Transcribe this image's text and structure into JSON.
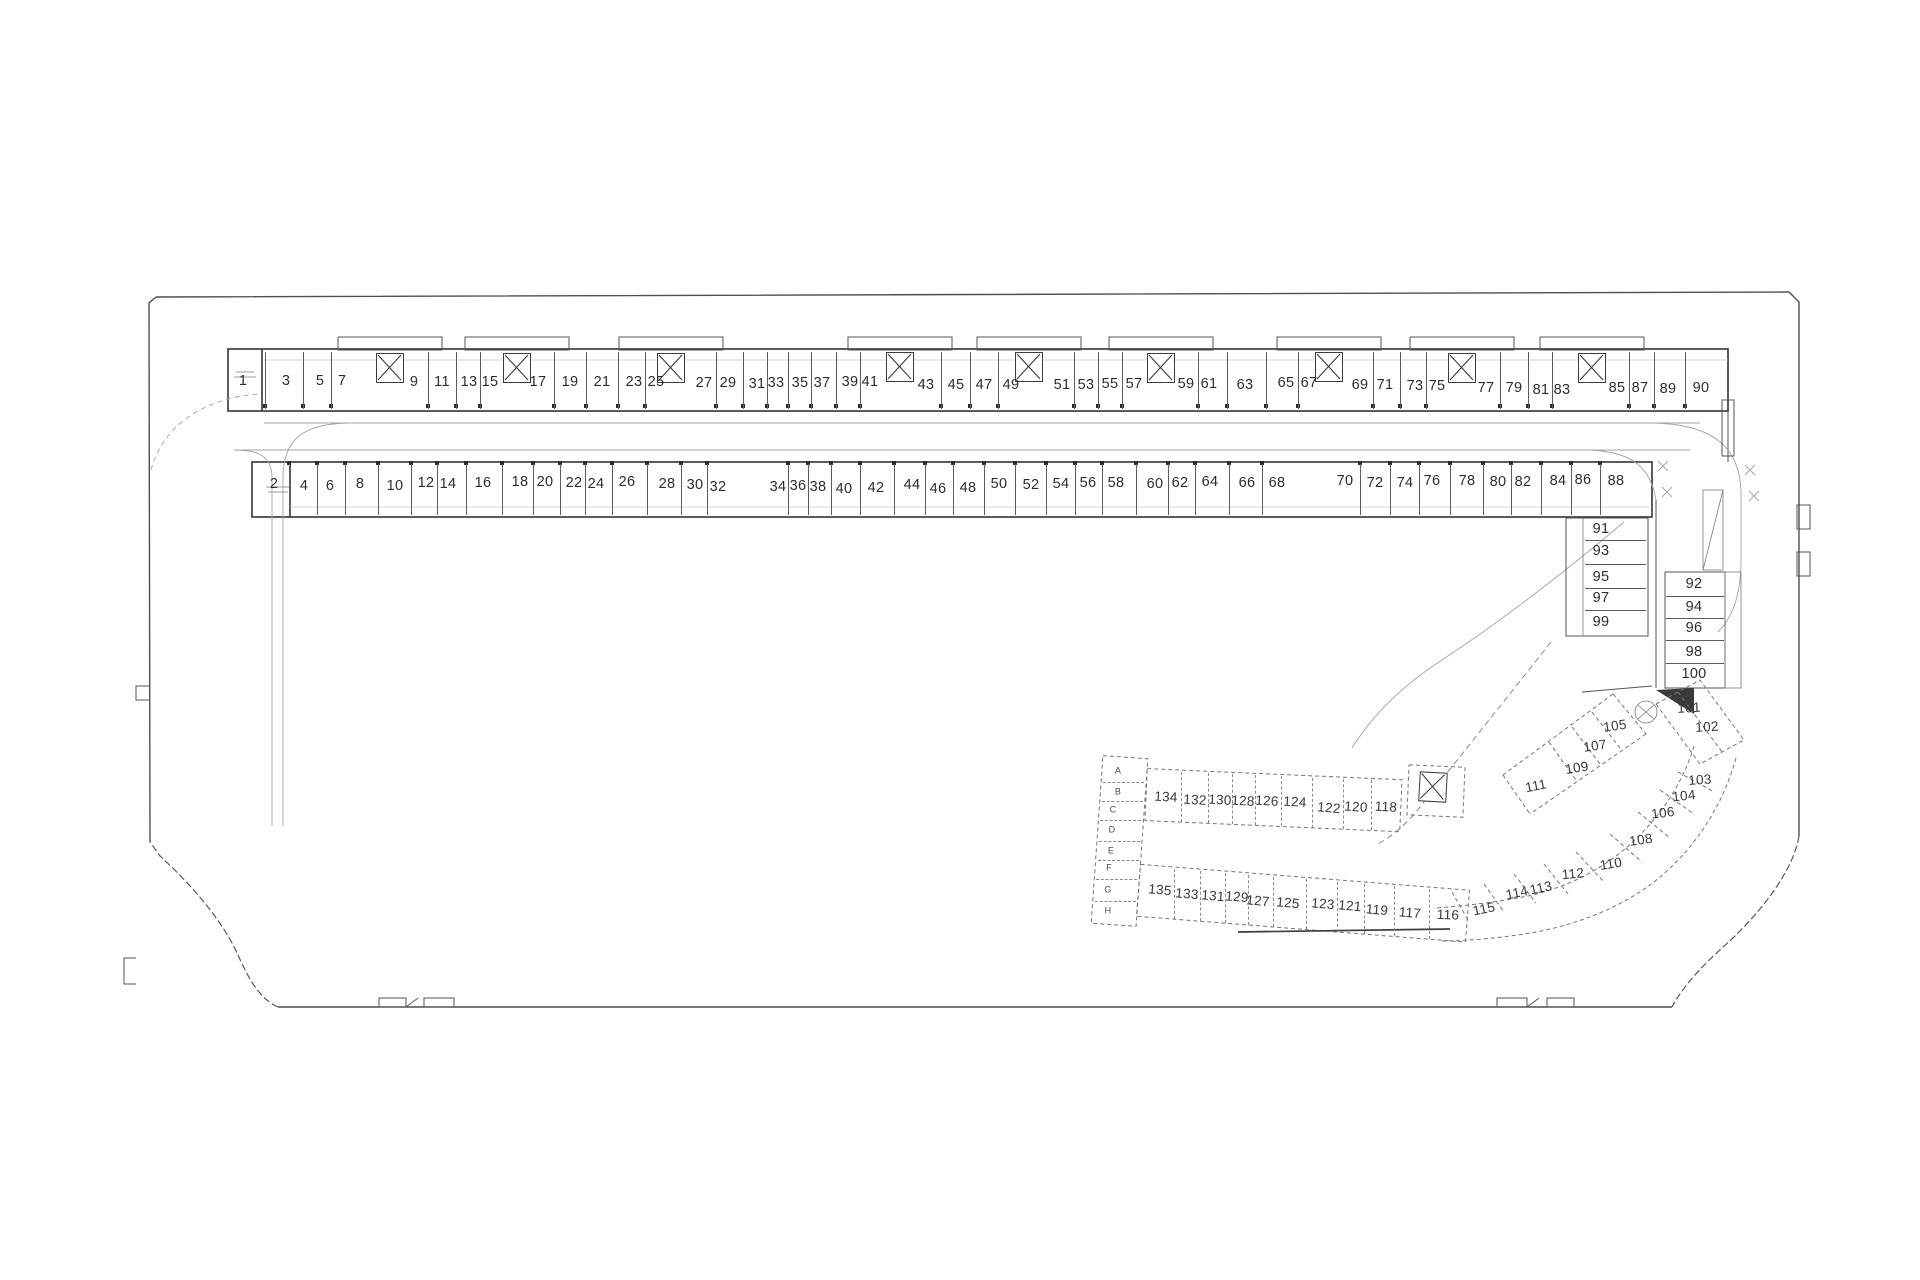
{
  "plan": {
    "colors": {
      "background": "#ffffff",
      "boundary_line": "#4f4f4f",
      "wall_line": "#3f3f3f",
      "dashed_section_line": "#767676",
      "label_text": "#2d2d2d"
    },
    "labels": [
      {
        "t": "1",
        "x": 243,
        "y": 381,
        "g": "r1"
      },
      {
        "t": "3",
        "x": 286,
        "y": 381,
        "g": "r1"
      },
      {
        "t": "5",
        "x": 320,
        "y": 381,
        "g": "r1"
      },
      {
        "t": "7",
        "x": 342,
        "y": 381,
        "g": "r1"
      },
      {
        "t": "9",
        "x": 414,
        "y": 382,
        "g": "r1"
      },
      {
        "t": "11",
        "x": 442,
        "y": 382,
        "g": "r1"
      },
      {
        "t": "13",
        "x": 469,
        "y": 382,
        "g": "r1"
      },
      {
        "t": "15",
        "x": 490,
        "y": 382,
        "g": "r1"
      },
      {
        "t": "17",
        "x": 538,
        "y": 382,
        "g": "r1"
      },
      {
        "t": "19",
        "x": 570,
        "y": 382,
        "g": "r1"
      },
      {
        "t": "21",
        "x": 602,
        "y": 382,
        "g": "r1"
      },
      {
        "t": "23",
        "x": 634,
        "y": 382,
        "g": "r1"
      },
      {
        "t": "25",
        "x": 656,
        "y": 382,
        "g": "r1"
      },
      {
        "t": "27",
        "x": 704,
        "y": 383,
        "g": "r1"
      },
      {
        "t": "29",
        "x": 728,
        "y": 383,
        "g": "r1"
      },
      {
        "t": "31",
        "x": 757,
        "y": 384,
        "g": "r1"
      },
      {
        "t": "33",
        "x": 776,
        "y": 383,
        "g": "r1"
      },
      {
        "t": "35",
        "x": 800,
        "y": 383,
        "g": "r1"
      },
      {
        "t": "37",
        "x": 822,
        "y": 383,
        "g": "r1"
      },
      {
        "t": "39",
        "x": 850,
        "y": 382,
        "g": "r1"
      },
      {
        "t": "41",
        "x": 870,
        "y": 382,
        "g": "r1"
      },
      {
        "t": "43",
        "x": 926,
        "y": 385,
        "g": "r1"
      },
      {
        "t": "45",
        "x": 956,
        "y": 385,
        "g": "r1"
      },
      {
        "t": "47",
        "x": 984,
        "y": 385,
        "g": "r1"
      },
      {
        "t": "49",
        "x": 1011,
        "y": 385,
        "g": "r1"
      },
      {
        "t": "51",
        "x": 1062,
        "y": 385,
        "g": "r1"
      },
      {
        "t": "53",
        "x": 1086,
        "y": 385,
        "g": "r1"
      },
      {
        "t": "55",
        "x": 1110,
        "y": 384,
        "g": "r1"
      },
      {
        "t": "57",
        "x": 1134,
        "y": 384,
        "g": "r1"
      },
      {
        "t": "59",
        "x": 1186,
        "y": 384,
        "g": "r1"
      },
      {
        "t": "61",
        "x": 1209,
        "y": 384,
        "g": "r1"
      },
      {
        "t": "63",
        "x": 1245,
        "y": 385,
        "g": "r1"
      },
      {
        "t": "65",
        "x": 1286,
        "y": 383,
        "g": "r1"
      },
      {
        "t": "67",
        "x": 1309,
        "y": 383,
        "g": "r1"
      },
      {
        "t": "69",
        "x": 1360,
        "y": 385,
        "g": "r1"
      },
      {
        "t": "71",
        "x": 1385,
        "y": 385,
        "g": "r1"
      },
      {
        "t": "73",
        "x": 1415,
        "y": 386,
        "g": "r1"
      },
      {
        "t": "75",
        "x": 1437,
        "y": 386,
        "g": "r1"
      },
      {
        "t": "77",
        "x": 1486,
        "y": 388,
        "g": "r1"
      },
      {
        "t": "79",
        "x": 1514,
        "y": 388,
        "g": "r1"
      },
      {
        "t": "81",
        "x": 1541,
        "y": 390,
        "g": "r1"
      },
      {
        "t": "83",
        "x": 1562,
        "y": 390,
        "g": "r1"
      },
      {
        "t": "85",
        "x": 1617,
        "y": 388,
        "g": "r1"
      },
      {
        "t": "87",
        "x": 1640,
        "y": 388,
        "g": "r1"
      },
      {
        "t": "89",
        "x": 1668,
        "y": 389,
        "g": "r1"
      },
      {
        "t": "90",
        "x": 1701,
        "y": 388,
        "g": "r1"
      },
      {
        "t": "2",
        "x": 274,
        "y": 484,
        "g": "r2"
      },
      {
        "t": "4",
        "x": 304,
        "y": 486,
        "g": "r2"
      },
      {
        "t": "6",
        "x": 330,
        "y": 486,
        "g": "r2"
      },
      {
        "t": "8",
        "x": 360,
        "y": 484,
        "g": "r2"
      },
      {
        "t": "10",
        "x": 395,
        "y": 486,
        "g": "r2"
      },
      {
        "t": "12",
        "x": 426,
        "y": 483,
        "g": "r2"
      },
      {
        "t": "14",
        "x": 448,
        "y": 484,
        "g": "r2"
      },
      {
        "t": "16",
        "x": 483,
        "y": 483,
        "g": "r2"
      },
      {
        "t": "18",
        "x": 520,
        "y": 482,
        "g": "r2"
      },
      {
        "t": "20",
        "x": 545,
        "y": 482,
        "g": "r2"
      },
      {
        "t": "22",
        "x": 574,
        "y": 483,
        "g": "r2"
      },
      {
        "t": "24",
        "x": 596,
        "y": 484,
        "g": "r2"
      },
      {
        "t": "26",
        "x": 627,
        "y": 482,
        "g": "r2"
      },
      {
        "t": "28",
        "x": 667,
        "y": 484,
        "g": "r2"
      },
      {
        "t": "30",
        "x": 695,
        "y": 485,
        "g": "r2"
      },
      {
        "t": "32",
        "x": 718,
        "y": 487,
        "g": "r2"
      },
      {
        "t": "34",
        "x": 778,
        "y": 487,
        "g": "r2"
      },
      {
        "t": "36",
        "x": 798,
        "y": 486,
        "g": "r2"
      },
      {
        "t": "38",
        "x": 818,
        "y": 487,
        "g": "r2"
      },
      {
        "t": "40",
        "x": 844,
        "y": 489,
        "g": "r2"
      },
      {
        "t": "42",
        "x": 876,
        "y": 488,
        "g": "r2"
      },
      {
        "t": "44",
        "x": 912,
        "y": 485,
        "g": "r2"
      },
      {
        "t": "46",
        "x": 938,
        "y": 489,
        "g": "r2"
      },
      {
        "t": "48",
        "x": 968,
        "y": 488,
        "g": "r2"
      },
      {
        "t": "50",
        "x": 999,
        "y": 484,
        "g": "r2"
      },
      {
        "t": "52",
        "x": 1031,
        "y": 485,
        "g": "r2"
      },
      {
        "t": "54",
        "x": 1061,
        "y": 484,
        "g": "r2"
      },
      {
        "t": "56",
        "x": 1088,
        "y": 483,
        "g": "r2"
      },
      {
        "t": "58",
        "x": 1116,
        "y": 483,
        "g": "r2"
      },
      {
        "t": "60",
        "x": 1155,
        "y": 484,
        "g": "r2"
      },
      {
        "t": "62",
        "x": 1180,
        "y": 483,
        "g": "r2"
      },
      {
        "t": "64",
        "x": 1210,
        "y": 482,
        "g": "r2"
      },
      {
        "t": "66",
        "x": 1247,
        "y": 483,
        "g": "r2"
      },
      {
        "t": "68",
        "x": 1277,
        "y": 483,
        "g": "r2"
      },
      {
        "t": "70",
        "x": 1345,
        "y": 481,
        "g": "r2"
      },
      {
        "t": "72",
        "x": 1375,
        "y": 483,
        "g": "r2"
      },
      {
        "t": "74",
        "x": 1405,
        "y": 483,
        "g": "r2"
      },
      {
        "t": "76",
        "x": 1432,
        "y": 481,
        "g": "r2"
      },
      {
        "t": "78",
        "x": 1467,
        "y": 481,
        "g": "r2"
      },
      {
        "t": "80",
        "x": 1498,
        "y": 482,
        "g": "r2"
      },
      {
        "t": "82",
        "x": 1523,
        "y": 482,
        "g": "r2"
      },
      {
        "t": "84",
        "x": 1558,
        "y": 481,
        "g": "r2"
      },
      {
        "t": "86",
        "x": 1583,
        "y": 480,
        "g": "r2"
      },
      {
        "t": "88",
        "x": 1616,
        "y": 481,
        "g": "r2"
      },
      {
        "t": "91",
        "x": 1601,
        "y": 529,
        "g": "s1"
      },
      {
        "t": "93",
        "x": 1601,
        "y": 551,
        "g": "s1"
      },
      {
        "t": "95",
        "x": 1601,
        "y": 577,
        "g": "s1"
      },
      {
        "t": "97",
        "x": 1601,
        "y": 598,
        "g": "s1"
      },
      {
        "t": "99",
        "x": 1601,
        "y": 622,
        "g": "s1"
      },
      {
        "t": "92",
        "x": 1694,
        "y": 584,
        "g": "s2"
      },
      {
        "t": "94",
        "x": 1694,
        "y": 607,
        "g": "s2"
      },
      {
        "t": "96",
        "x": 1694,
        "y": 628,
        "g": "s2"
      },
      {
        "t": "98",
        "x": 1694,
        "y": 652,
        "g": "s2"
      },
      {
        "t": "100",
        "x": 1694,
        "y": 674,
        "g": "s2"
      },
      {
        "t": "101",
        "x": 1689,
        "y": 708,
        "k": "c",
        "r": -3
      },
      {
        "t": "102",
        "x": 1707,
        "y": 727,
        "k": "c",
        "r": -3
      },
      {
        "t": "103",
        "x": 1700,
        "y": 780,
        "k": "c",
        "r": -4
      },
      {
        "t": "104",
        "x": 1684,
        "y": 796,
        "k": "c",
        "r": -6
      },
      {
        "t": "105",
        "x": 1615,
        "y": 726,
        "k": "c",
        "r": -8
      },
      {
        "t": "106",
        "x": 1663,
        "y": 813,
        "k": "c",
        "r": -7
      },
      {
        "t": "107",
        "x": 1595,
        "y": 746,
        "k": "c",
        "r": -8
      },
      {
        "t": "108",
        "x": 1641,
        "y": 840,
        "k": "c",
        "r": -8
      },
      {
        "t": "109",
        "x": 1577,
        "y": 768,
        "k": "c",
        "r": -9
      },
      {
        "t": "110",
        "x": 1611,
        "y": 864,
        "k": "c",
        "r": -9
      },
      {
        "t": "111",
        "x": 1536,
        "y": 786,
        "k": "c",
        "r": -11
      },
      {
        "t": "112",
        "x": 1573,
        "y": 874,
        "k": "c",
        "r": -6
      },
      {
        "t": "113",
        "x": 1541,
        "y": 888,
        "k": "c",
        "r": -12
      },
      {
        "t": "114",
        "x": 1517,
        "y": 893,
        "k": "c",
        "r": -11
      },
      {
        "t": "115",
        "x": 1484,
        "y": 909,
        "k": "c",
        "r": -12
      },
      {
        "t": "134",
        "x": 1166,
        "y": 797,
        "g": "b1",
        "k": "c",
        "r": 3
      },
      {
        "t": "132",
        "x": 1195,
        "y": 800,
        "g": "b1",
        "k": "c",
        "r": 3
      },
      {
        "t": "130",
        "x": 1220,
        "y": 800,
        "g": "b1",
        "k": "c",
        "r": 3
      },
      {
        "t": "128",
        "x": 1243,
        "y": 801,
        "g": "b1",
        "k": "c",
        "r": 3
      },
      {
        "t": "126",
        "x": 1267,
        "y": 801,
        "g": "b1",
        "k": "c",
        "r": 3
      },
      {
        "t": "124",
        "x": 1295,
        "y": 802,
        "g": "b1",
        "k": "c",
        "r": 3
      },
      {
        "t": "122",
        "x": 1329,
        "y": 808,
        "g": "b1",
        "k": "c",
        "r": 5
      },
      {
        "t": "120",
        "x": 1356,
        "y": 807,
        "g": "b1",
        "k": "c",
        "r": 4
      },
      {
        "t": "118",
        "x": 1386,
        "y": 807,
        "g": "b1",
        "k": "c",
        "r": 3
      },
      {
        "t": "135",
        "x": 1160,
        "y": 890,
        "g": "b2",
        "k": "c",
        "r": 5
      },
      {
        "t": "133",
        "x": 1187,
        "y": 894,
        "g": "b2",
        "k": "c",
        "r": 5
      },
      {
        "t": "131",
        "x": 1213,
        "y": 896,
        "g": "b2",
        "k": "c",
        "r": 5
      },
      {
        "t": "129",
        "x": 1237,
        "y": 897,
        "g": "b2",
        "k": "c",
        "r": 5
      },
      {
        "t": "127",
        "x": 1258,
        "y": 901,
        "g": "b2",
        "k": "c",
        "r": 5
      },
      {
        "t": "125",
        "x": 1288,
        "y": 903,
        "g": "b2",
        "k": "c",
        "r": 5
      },
      {
        "t": "123",
        "x": 1323,
        "y": 904,
        "g": "b2",
        "k": "c",
        "r": 5
      },
      {
        "t": "121",
        "x": 1350,
        "y": 906,
        "g": "b2",
        "k": "c",
        "r": 5
      },
      {
        "t": "119",
        "x": 1377,
        "y": 910,
        "g": "b2",
        "k": "c",
        "r": 5
      },
      {
        "t": "117",
        "x": 1410,
        "y": 913,
        "g": "b2",
        "k": "c",
        "r": 5
      },
      {
        "t": "116",
        "x": 1448,
        "y": 915,
        "g": "b2",
        "k": "c",
        "r": 2
      },
      {
        "t": "A",
        "x": 1118,
        "y": 771,
        "g": "bl",
        "k": "s"
      },
      {
        "t": "B",
        "x": 1118,
        "y": 792,
        "g": "bl",
        "k": "s"
      },
      {
        "t": "C",
        "x": 1113,
        "y": 810,
        "g": "bl",
        "k": "s"
      },
      {
        "t": "D",
        "x": 1112,
        "y": 830,
        "g": "bl",
        "k": "s"
      },
      {
        "t": "E",
        "x": 1111,
        "y": 851,
        "g": "bl",
        "k": "s"
      },
      {
        "t": "F",
        "x": 1109,
        "y": 868,
        "g": "bl",
        "k": "s"
      },
      {
        "t": "G",
        "x": 1108,
        "y": 890,
        "g": "bl",
        "k": "s"
      },
      {
        "t": "H",
        "x": 1108,
        "y": 911,
        "g": "bl",
        "k": "s"
      }
    ],
    "shafts": [
      {
        "x": 390,
        "y": 368
      },
      {
        "x": 517,
        "y": 368
      },
      {
        "x": 671,
        "y": 368
      },
      {
        "x": 900,
        "y": 367
      },
      {
        "x": 1029,
        "y": 367
      },
      {
        "x": 1161,
        "y": 368
      },
      {
        "x": 1329,
        "y": 367
      },
      {
        "x": 1462,
        "y": 368
      },
      {
        "x": 1592,
        "y": 368
      },
      {
        "x": 1433,
        "y": 787,
        "r": 3
      }
    ]
  }
}
